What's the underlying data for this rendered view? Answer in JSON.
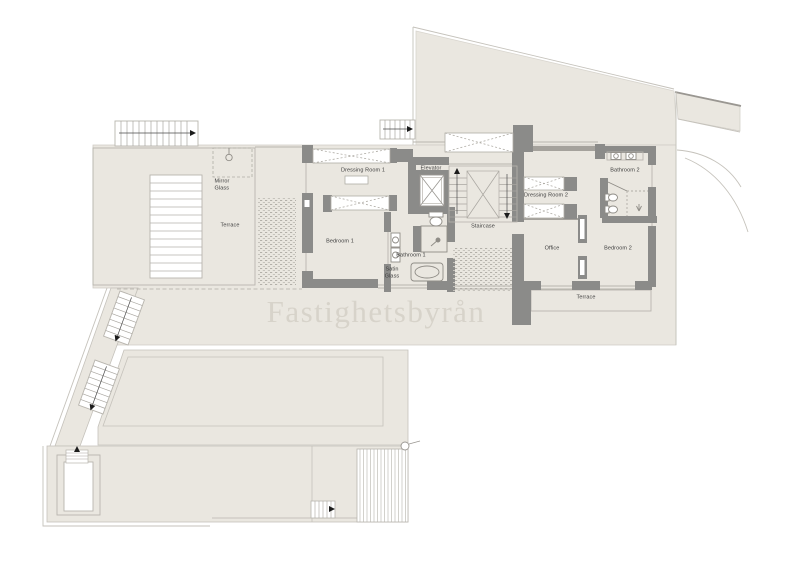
{
  "watermark": {
    "text": "Fastighetsbyrån"
  },
  "labels": [
    {
      "id": "mirror-glass",
      "text": "Mirror\nGlass"
    },
    {
      "id": "terrace-left",
      "text": "Terrace"
    },
    {
      "id": "dressing-room-1",
      "text": "Dressing Room 1"
    },
    {
      "id": "elevator",
      "text": "Elevator"
    },
    {
      "id": "staircase",
      "text": "Staircase"
    },
    {
      "id": "bedroom-1",
      "text": "Bedroom 1"
    },
    {
      "id": "bathroom-1",
      "text": "Bathroom 1"
    },
    {
      "id": "satin-glass",
      "text": "Satin\nGlass"
    },
    {
      "id": "dressing-room-2",
      "text": "Dressing Room 2"
    },
    {
      "id": "bathroom-2",
      "text": "Bathroom 2"
    },
    {
      "id": "office",
      "text": "Office"
    },
    {
      "id": "bedroom-2",
      "text": "Bedroom 2"
    },
    {
      "id": "terrace-right",
      "text": "Terrace"
    }
  ],
  "colors": {
    "floor": "#EAE7E0",
    "wall": "#8B8B89",
    "thin_line": "#BDBAB3",
    "label_text": "#3D3D3D",
    "watermark": "#D7D3CA"
  }
}
